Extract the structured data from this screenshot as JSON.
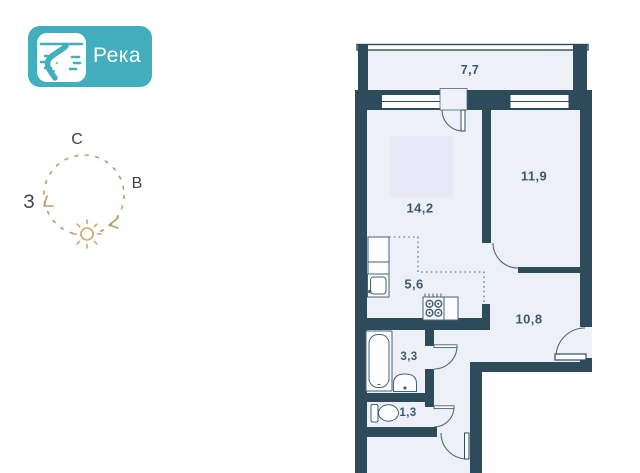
{
  "logo": {
    "name": "Река",
    "icon": "river-icon",
    "accent_color": "#43aebd"
  },
  "compass": {
    "north_label": "С",
    "east_label": "В",
    "west_label": "З",
    "sun_icon": "sun-icon",
    "ring_color": "#bb9c66"
  },
  "floorplan": {
    "rooms": [
      {
        "id": "balcony",
        "area_label": "7,7"
      },
      {
        "id": "living-room",
        "area_label": "14,2"
      },
      {
        "id": "bedroom",
        "area_label": "11,9"
      },
      {
        "id": "kitchen",
        "area_label": "5,6"
      },
      {
        "id": "hallway",
        "area_label": "10,8"
      },
      {
        "id": "bathroom",
        "area_label": "3,3"
      },
      {
        "id": "wc",
        "area_label": "1,3"
      }
    ],
    "fixtures": [
      "kitchen-cabinet-icon",
      "kitchen-sink-icon",
      "stove-icon",
      "bathtub-icon",
      "washbasin-icon",
      "toilet-icon"
    ],
    "colors": {
      "wall": "#2e4b5c",
      "floor": "#edf0f7",
      "rug": "#e9e8f7",
      "label": "#3d5970",
      "door_arc": "#51677a"
    }
  }
}
